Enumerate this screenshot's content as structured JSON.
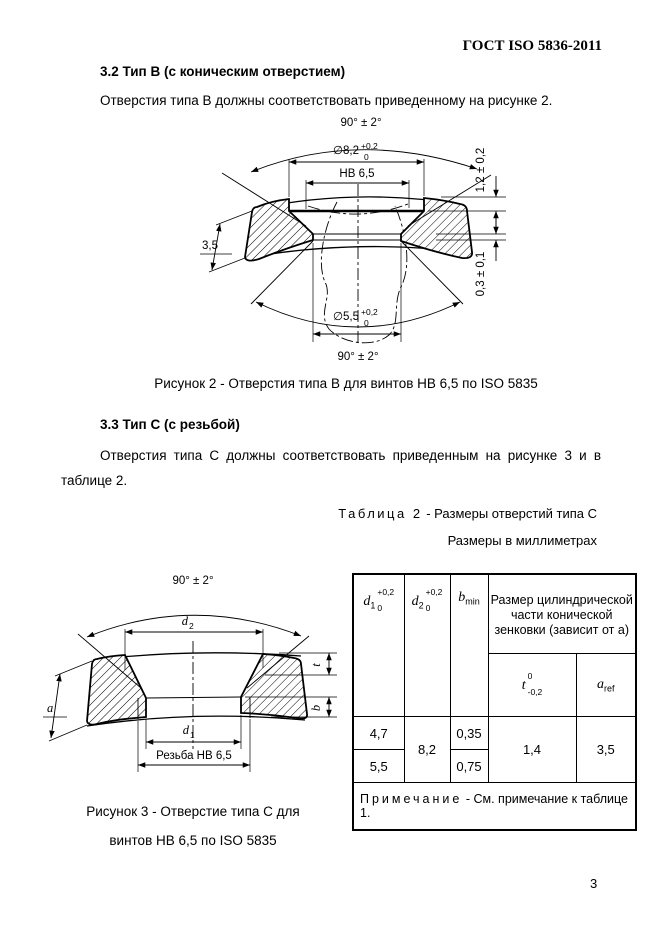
{
  "header": {
    "title": "ГОСТ ISO 5836-2011"
  },
  "page": {
    "number": "3"
  },
  "section_b": {
    "heading": "3.2  Тип B (с коническим отверстием)",
    "paragraph": "Отверстия типа B должны соответствовать приведенному на рисунке 2."
  },
  "figure2": {
    "angle_top": "90° ± 2°",
    "dia_top": "∅8,2",
    "dia_top_sup": "+0,2",
    "dia_top_sub": "0",
    "screw": "HB 6,5",
    "depth": "1,2 ± 0,2",
    "thickness": "3,5",
    "step": "0,3 ± 0,1",
    "dia_bottom": "∅5,5",
    "dia_bottom_sup": "+0,2",
    "dia_bottom_sub": "0",
    "angle_bottom": "90° ± 2°",
    "caption": "Рисунок 2 - Отверстия типа B для винтов HB 6,5 по ISO 5835"
  },
  "section_c": {
    "heading": "3.3  Тип C (с резьбой)",
    "paragraph": "Отверстия типа C должны соответствовать приведенным на рисунке 3 и в таблице 2."
  },
  "table2": {
    "title_label": "Таблица 2",
    "title_rest": "- Размеры отверстий типа C",
    "units": "Размеры в миллиметрах",
    "col_d1": {
      "name": "d",
      "sub": "1",
      "tol_top": "+0,2",
      "tol_bottom": "0"
    },
    "col_d2": {
      "name": "d",
      "sub": "2",
      "tol_top": "+0,2",
      "tol_bottom": "0"
    },
    "col_b": {
      "name": "b",
      "sub": "min"
    },
    "group_header": "Размер цилиндрической части конической зенковки (зависит от а)",
    "col_t": {
      "name": "t",
      "tol_top": "0",
      "tol_bottom": "-0,2"
    },
    "col_a": {
      "name": "a",
      "sub": "ref"
    },
    "values": {
      "d1_row1": "4,7",
      "d1_row2": "5,5",
      "d2": "8,2",
      "b_row1": "0,35",
      "b_row2": "0,75",
      "t": "1,4",
      "a": "3,5"
    },
    "note_label": "Примечание",
    "note_rest": "- См. примечание к таблице 1."
  },
  "figure3": {
    "angle": "90° ± 2°",
    "d2_name": "d",
    "d2_sub": "2",
    "t": "t",
    "b": "b",
    "a": "a",
    "d1_name": "d",
    "d1_sub": "1",
    "thread": "Резьба HB 6,5",
    "caption_line1": "Рисунок 3 - Отверстие типа C для",
    "caption_line2": "винтов HB 6,5 по ISO 5835"
  }
}
